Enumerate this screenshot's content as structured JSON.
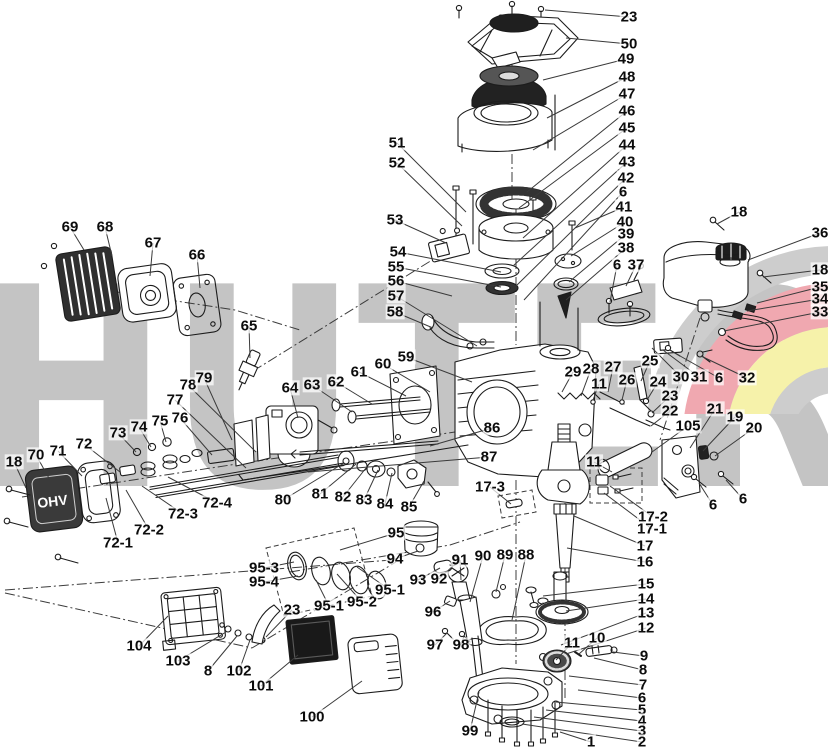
{
  "watermark": {
    "text": "HUTER",
    "text_color": "#c4c4c4",
    "logo_red": "#f0a8b0",
    "logo_yellow": "#f6f2aa",
    "logo_gray": "#cdcdcd"
  },
  "diagram": {
    "ohv_text": "OHV",
    "label_color": "#0c0c0c",
    "leader_color": "#3a3a3a",
    "labels": [
      {
        "id": "23a",
        "t": "23",
        "x": 629,
        "y": 17,
        "tx": 545,
        "ty": 10
      },
      {
        "id": "50",
        "t": "50",
        "x": 629,
        "y": 44,
        "tx": 566,
        "ty": 38
      },
      {
        "id": "49",
        "t": "49",
        "x": 626,
        "y": 59,
        "tx": 543,
        "ty": 80
      },
      {
        "id": "48",
        "t": "48",
        "x": 627,
        "y": 77,
        "tx": 547,
        "ty": 118
      },
      {
        "id": "47",
        "t": "47",
        "x": 627,
        "y": 94,
        "tx": 533,
        "ty": 150
      },
      {
        "id": "46",
        "t": "46",
        "x": 627,
        "y": 111,
        "tx": 527,
        "ty": 192
      },
      {
        "id": "45",
        "t": "45",
        "x": 627,
        "y": 128,
        "tx": 519,
        "ty": 208
      },
      {
        "id": "44",
        "t": "44",
        "x": 627,
        "y": 145,
        "tx": 523,
        "ty": 238
      },
      {
        "id": "43",
        "t": "43",
        "x": 627,
        "y": 162,
        "tx": 513,
        "ty": 266
      },
      {
        "id": "42",
        "t": "42",
        "x": 626,
        "y": 178,
        "tx": 516,
        "ty": 286
      },
      {
        "id": "6a",
        "t": "6",
        "x": 623,
        "y": 192,
        "tx": 524,
        "ty": 300
      },
      {
        "id": "41",
        "t": "41",
        "x": 624,
        "y": 207,
        "tx": 575,
        "ty": 228
      },
      {
        "id": "40",
        "t": "40",
        "x": 625,
        "y": 222,
        "tx": 571,
        "ty": 256
      },
      {
        "id": "39",
        "t": "39",
        "x": 626,
        "y": 234,
        "tx": 569,
        "ty": 282
      },
      {
        "id": "38a",
        "t": "38",
        "x": 626,
        "y": 248,
        "tx": 566,
        "ty": 300
      },
      {
        "id": "6b",
        "t": "6",
        "x": 617,
        "y": 265,
        "tx": 610,
        "ty": 302
      },
      {
        "id": "37",
        "t": "37",
        "x": 636,
        "y": 265,
        "tx": 626,
        "ty": 286
      },
      {
        "id": "18a",
        "t": "18",
        "x": 739,
        "y": 212,
        "tx": 717,
        "ty": 224
      },
      {
        "id": "36",
        "t": "36",
        "x": 820,
        "y": 233,
        "tx": 748,
        "ty": 260
      },
      {
        "id": "18b",
        "t": "18",
        "x": 820,
        "y": 270,
        "tx": 763,
        "ty": 277
      },
      {
        "id": "35",
        "t": "35",
        "x": 820,
        "y": 287,
        "tx": 757,
        "ty": 303
      },
      {
        "id": "34",
        "t": "34",
        "x": 820,
        "y": 299,
        "tx": 747,
        "ty": 311
      },
      {
        "id": "33",
        "t": "33",
        "x": 820,
        "y": 312,
        "tx": 724,
        "ty": 331
      },
      {
        "id": "51",
        "t": "51",
        "x": 397,
        "y": 143,
        "tx": 466,
        "ty": 212
      },
      {
        "id": "52",
        "t": "52",
        "x": 397,
        "y": 163,
        "tx": 462,
        "ty": 226
      },
      {
        "id": "53",
        "t": "53",
        "x": 395,
        "y": 220,
        "tx": 446,
        "ty": 243
      },
      {
        "id": "54",
        "t": "54",
        "x": 398,
        "y": 252,
        "tx": 501,
        "ty": 272
      },
      {
        "id": "55",
        "t": "55",
        "x": 396,
        "y": 267,
        "tx": 501,
        "ty": 287
      },
      {
        "id": "56",
        "t": "56",
        "x": 396,
        "y": 281,
        "tx": 452,
        "ty": 296
      },
      {
        "id": "57",
        "t": "57",
        "x": 396,
        "y": 296,
        "tx": 477,
        "ty": 346
      },
      {
        "id": "58",
        "t": "58",
        "x": 395,
        "y": 312,
        "tx": 433,
        "ty": 328
      },
      {
        "id": "59",
        "t": "59",
        "x": 406,
        "y": 357,
        "tx": 472,
        "ty": 382
      },
      {
        "id": "60",
        "t": "60",
        "x": 383,
        "y": 364,
        "tx": 430,
        "ty": 392
      },
      {
        "id": "61",
        "t": "61",
        "x": 359,
        "y": 372,
        "tx": 406,
        "ty": 396
      },
      {
        "id": "62",
        "t": "62",
        "x": 336,
        "y": 382,
        "tx": 372,
        "ty": 404
      },
      {
        "id": "63",
        "t": "63",
        "x": 312,
        "y": 385,
        "tx": 352,
        "ty": 412
      },
      {
        "id": "64",
        "t": "64",
        "x": 290,
        "y": 388,
        "tx": 298,
        "ty": 418
      },
      {
        "id": "69",
        "t": "69",
        "x": 70,
        "y": 227,
        "tx": 84,
        "ty": 250
      },
      {
        "id": "68",
        "t": "68",
        "x": 105,
        "y": 227,
        "tx": 112,
        "ty": 256
      },
      {
        "id": "67",
        "t": "67",
        "x": 153,
        "y": 243,
        "tx": 150,
        "ty": 276
      },
      {
        "id": "66",
        "t": "66",
        "x": 197,
        "y": 255,
        "tx": 200,
        "ty": 288
      },
      {
        "id": "65",
        "t": "65",
        "x": 249,
        "y": 326,
        "tx": 250,
        "ty": 358
      },
      {
        "id": "18c",
        "t": "18",
        "x": 14,
        "y": 462,
        "tx": 26,
        "ty": 488
      },
      {
        "id": "70",
        "t": "70",
        "x": 36,
        "y": 455,
        "tx": 50,
        "ty": 480
      },
      {
        "id": "71",
        "t": "71",
        "x": 58,
        "y": 451,
        "tx": 82,
        "ty": 476
      },
      {
        "id": "72",
        "t": "72",
        "x": 84,
        "y": 444,
        "tx": 120,
        "ty": 472
      },
      {
        "id": "73",
        "t": "73",
        "x": 118,
        "y": 433,
        "tx": 136,
        "ty": 452
      },
      {
        "id": "74",
        "t": "74",
        "x": 139,
        "y": 427,
        "tx": 151,
        "ty": 447
      },
      {
        "id": "75",
        "t": "75",
        "x": 160,
        "y": 421,
        "tx": 166,
        "ty": 442
      },
      {
        "id": "76",
        "t": "76",
        "x": 180,
        "y": 418,
        "tx": 212,
        "ty": 455
      },
      {
        "id": "77",
        "t": "77",
        "x": 175,
        "y": 400,
        "tx": 246,
        "ty": 468
      },
      {
        "id": "78",
        "t": "78",
        "x": 188,
        "y": 385,
        "tx": 256,
        "ty": 452
      },
      {
        "id": "79",
        "t": "79",
        "x": 204,
        "y": 378,
        "tx": 232,
        "ty": 440
      },
      {
        "id": "72-1",
        "t": "72-1",
        "x": 118,
        "y": 543,
        "tx": 106,
        "ty": 498
      },
      {
        "id": "72-2",
        "t": "72-2",
        "x": 149,
        "y": 530,
        "tx": 126,
        "ty": 490
      },
      {
        "id": "72-3",
        "t": "72-3",
        "x": 183,
        "y": 514,
        "tx": 142,
        "ty": 486
      },
      {
        "id": "72-4",
        "t": "72-4",
        "x": 217,
        "y": 503,
        "tx": 168,
        "ty": 477
      },
      {
        "id": "80",
        "t": "80",
        "x": 283,
        "y": 500,
        "tx": 344,
        "ty": 463
      },
      {
        "id": "81",
        "t": "81",
        "x": 320,
        "y": 494,
        "tx": 356,
        "ty": 464
      },
      {
        "id": "82",
        "t": "82",
        "x": 343,
        "y": 497,
        "tx": 366,
        "ty": 468
      },
      {
        "id": "83",
        "t": "83",
        "x": 364,
        "y": 500,
        "tx": 378,
        "ty": 470
      },
      {
        "id": "84",
        "t": "84",
        "x": 385,
        "y": 504,
        "tx": 392,
        "ty": 473
      },
      {
        "id": "85",
        "t": "85",
        "x": 409,
        "y": 507,
        "tx": 424,
        "ty": 481
      },
      {
        "id": "86",
        "t": "86",
        "x": 492,
        "y": 428,
        "tx": 430,
        "ty": 446
      },
      {
        "id": "87",
        "t": "87",
        "x": 489,
        "y": 457,
        "tx": 308,
        "ty": 472
      },
      {
        "id": "17-3",
        "t": "17-3",
        "x": 490,
        "y": 487,
        "tx": 511,
        "ty": 504
      },
      {
        "id": "29",
        "t": "29",
        "x": 573,
        "y": 372,
        "tx": 562,
        "ty": 392
      },
      {
        "id": "28",
        "t": "28",
        "x": 591,
        "y": 369,
        "tx": 581,
        "ty": 396
      },
      {
        "id": "27",
        "t": "27",
        "x": 613,
        "y": 367,
        "tx": 608,
        "ty": 392
      },
      {
        "id": "11c",
        "t": "11",
        "x": 599,
        "y": 384,
        "tx": 593,
        "ty": 400
      },
      {
        "id": "26",
        "t": "26",
        "x": 627,
        "y": 380,
        "tx": 622,
        "ty": 400
      },
      {
        "id": "25",
        "t": "25",
        "x": 650,
        "y": 361,
        "tx": 641,
        "ty": 381
      },
      {
        "id": "24",
        "t": "24",
        "x": 658,
        "y": 382,
        "tx": 647,
        "ty": 400
      },
      {
        "id": "23c",
        "t": "23",
        "x": 670,
        "y": 396,
        "tx": 652,
        "ty": 413
      },
      {
        "id": "22",
        "t": "22",
        "x": 670,
        "y": 411,
        "tx": 651,
        "ty": 426
      },
      {
        "id": "30",
        "t": "30",
        "x": 681,
        "y": 377,
        "tx": 652,
        "ty": 348
      },
      {
        "id": "31",
        "t": "31",
        "x": 699,
        "y": 377,
        "tx": 663,
        "ty": 350
      },
      {
        "id": "6d",
        "t": "6",
        "x": 719,
        "y": 378,
        "tx": 673,
        "ty": 352
      },
      {
        "id": "32",
        "t": "32",
        "x": 747,
        "y": 378,
        "tx": 701,
        "ty": 356
      },
      {
        "id": "105",
        "t": "105",
        "x": 688,
        "y": 426,
        "tx": 652,
        "ty": 452
      },
      {
        "id": "21",
        "t": "21",
        "x": 715,
        "y": 409,
        "tx": 690,
        "ty": 448
      },
      {
        "id": "19",
        "t": "19",
        "x": 735,
        "y": 417,
        "tx": 703,
        "ty": 451
      },
      {
        "id": "20",
        "t": "20",
        "x": 754,
        "y": 428,
        "tx": 715,
        "ty": 456
      },
      {
        "id": "11d",
        "t": "11",
        "x": 594,
        "y": 462,
        "tx": 612,
        "ty": 472
      },
      {
        "id": "6e",
        "t": "6",
        "x": 713,
        "y": 505,
        "tx": 699,
        "ty": 483
      },
      {
        "id": "6f",
        "t": "6",
        "x": 743,
        "y": 499,
        "tx": 726,
        "ty": 480
      },
      {
        "id": "17-2",
        "t": "17-2",
        "x": 653,
        "y": 517,
        "tx": 610,
        "ty": 486
      },
      {
        "id": "17-1",
        "t": "17-1",
        "x": 652,
        "y": 529,
        "tx": 604,
        "ty": 493
      },
      {
        "id": "17",
        "t": "17",
        "x": 645,
        "y": 546,
        "tx": 574,
        "ty": 516
      },
      {
        "id": "16",
        "t": "16",
        "x": 645,
        "y": 562,
        "tx": 567,
        "ty": 548
      },
      {
        "id": "15",
        "t": "15",
        "x": 646,
        "y": 584,
        "tx": 543,
        "ty": 596
      },
      {
        "id": "14",
        "t": "14",
        "x": 646,
        "y": 599,
        "tx": 566,
        "ty": 611
      },
      {
        "id": "13",
        "t": "13",
        "x": 646,
        "y": 613,
        "tx": 561,
        "ty": 645
      },
      {
        "id": "12",
        "t": "12",
        "x": 646,
        "y": 628,
        "tx": 566,
        "ty": 654
      },
      {
        "id": "11e",
        "t": "11",
        "x": 572,
        "y": 643,
        "tx": 556,
        "ty": 660
      },
      {
        "id": "10",
        "t": "10",
        "x": 597,
        "y": 638,
        "tx": 579,
        "ty": 654
      },
      {
        "id": "9",
        "t": "9",
        "x": 644,
        "y": 656,
        "tx": 613,
        "ty": 652
      },
      {
        "id": "8b",
        "t": "8",
        "x": 643,
        "y": 670,
        "tx": 594,
        "ty": 658
      },
      {
        "id": "7",
        "t": "7",
        "x": 643,
        "y": 685,
        "tx": 569,
        "ty": 676
      },
      {
        "id": "6g",
        "t": "6",
        "x": 642,
        "y": 698,
        "tx": 578,
        "ty": 690
      },
      {
        "id": "5",
        "t": "5",
        "x": 642,
        "y": 710,
        "tx": 556,
        "ty": 702
      },
      {
        "id": "4",
        "t": "4",
        "x": 642,
        "y": 721,
        "tx": 546,
        "ty": 710
      },
      {
        "id": "3",
        "t": "3",
        "x": 642,
        "y": 731,
        "tx": 534,
        "ty": 717
      },
      {
        "id": "2",
        "t": "2",
        "x": 642,
        "y": 742,
        "tx": 522,
        "ty": 724
      },
      {
        "id": "1",
        "t": "1",
        "x": 591,
        "y": 742,
        "tx": 560,
        "ty": 732
      },
      {
        "id": "95-3",
        "t": "95-3",
        "x": 264,
        "y": 568,
        "tx": 294,
        "ty": 562
      },
      {
        "id": "95-4",
        "t": "95-4",
        "x": 264,
        "y": 582,
        "tx": 298,
        "ty": 576
      },
      {
        "id": "95",
        "t": "95",
        "x": 396,
        "y": 533,
        "tx": 340,
        "ty": 550
      },
      {
        "id": "94",
        "t": "94",
        "x": 395,
        "y": 559,
        "tx": 418,
        "ty": 551
      },
      {
        "id": "93",
        "t": "93",
        "x": 418,
        "y": 580,
        "tx": 440,
        "ty": 568
      },
      {
        "id": "92",
        "t": "92",
        "x": 439,
        "y": 579,
        "tx": 454,
        "ty": 565
      },
      {
        "id": "95-1a",
        "t": "95-1",
        "x": 329,
        "y": 606,
        "tx": 316,
        "ty": 580
      },
      {
        "id": "95-2",
        "t": "95-2",
        "x": 362,
        "y": 602,
        "tx": 337,
        "ty": 574
      },
      {
        "id": "95-1b",
        "t": "95-1",
        "x": 390,
        "y": 590,
        "tx": 357,
        "ty": 567
      },
      {
        "id": "91",
        "t": "91",
        "x": 460,
        "y": 560,
        "tx": 461,
        "ty": 580
      },
      {
        "id": "90",
        "t": "90",
        "x": 483,
        "y": 556,
        "tx": 470,
        "ty": 602
      },
      {
        "id": "89",
        "t": "89",
        "x": 505,
        "y": 555,
        "tx": 496,
        "ty": 592
      },
      {
        "id": "88",
        "t": "88",
        "x": 526,
        "y": 555,
        "tx": 512,
        "ty": 620
      },
      {
        "id": "96",
        "t": "96",
        "x": 433,
        "y": 612,
        "tx": 450,
        "ty": 601
      },
      {
        "id": "97",
        "t": "97",
        "x": 435,
        "y": 645,
        "tx": 447,
        "ty": 633
      },
      {
        "id": "98",
        "t": "98",
        "x": 461,
        "y": 645,
        "tx": 464,
        "ty": 636
      },
      {
        "id": "99",
        "t": "99",
        "x": 470,
        "y": 731,
        "tx": 479,
        "ty": 692
      },
      {
        "id": "104",
        "t": "104",
        "x": 139,
        "y": 646,
        "tx": 168,
        "ty": 616
      },
      {
        "id": "103",
        "t": "103",
        "x": 178,
        "y": 661,
        "tx": 226,
        "ty": 632
      },
      {
        "id": "8a",
        "t": "8",
        "x": 208,
        "y": 671,
        "tx": 237,
        "ty": 636
      },
      {
        "id": "102",
        "t": "102",
        "x": 239,
        "y": 671,
        "tx": 250,
        "ty": 640
      },
      {
        "id": "23b",
        "t": "23",
        "x": 292,
        "y": 610,
        "tx": 266,
        "ty": 637
      },
      {
        "id": "101",
        "t": "101",
        "x": 261,
        "y": 686,
        "tx": 298,
        "ty": 655
      },
      {
        "id": "100",
        "t": "100",
        "x": 312,
        "y": 717,
        "tx": 362,
        "ty": 681
      }
    ]
  }
}
